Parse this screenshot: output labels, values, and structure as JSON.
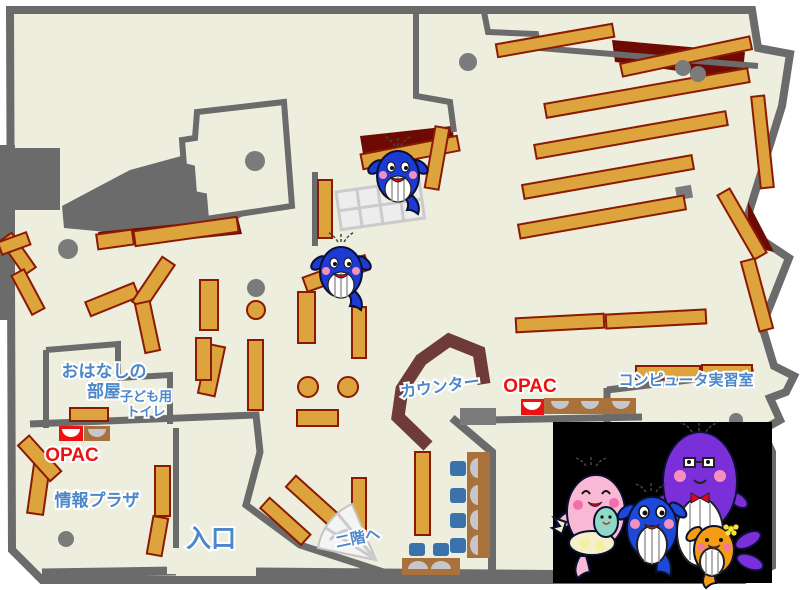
{
  "map": {
    "labels": {
      "storytelling_room_line1": "おはなしの",
      "storytelling_room_line2": "部屋",
      "kids_toilet_line1": "子ども用",
      "kids_toilet_line2": "トイレ",
      "opac_children_area": "OPAC",
      "info_plaza": "情報プラザ",
      "entrance": "入口",
      "to_second_floor": "二階へ",
      "counter": "カウンター",
      "opac_main": "OPAC",
      "computer_room": "コンピュータ実習室"
    },
    "colors": {
      "floor": "#edeede",
      "wall": "#6b6b6b",
      "shelf": "#dda33d",
      "shelf_border": "#8b1a04",
      "dark_red": "#6e0a04",
      "counter": "#6e3b38",
      "column": "#7b7b7b",
      "label_blue": "#4b87c9",
      "label_red": "#ee1111",
      "chair_blue": "#3c72ab",
      "desk_brown": "#a9713b",
      "monitor": "#c6c6cc",
      "panel_black": "#000000",
      "stairs": "#f4f4f4"
    },
    "mascots": {
      "map_sprites": [
        "blue-whale-mascot",
        "blue-whale-mascot"
      ],
      "family_panel": [
        "pink-whale-mother",
        "teal-whale-baby",
        "blue-whale-child",
        "purple-whale-father",
        "orange-whale-child"
      ]
    }
  }
}
